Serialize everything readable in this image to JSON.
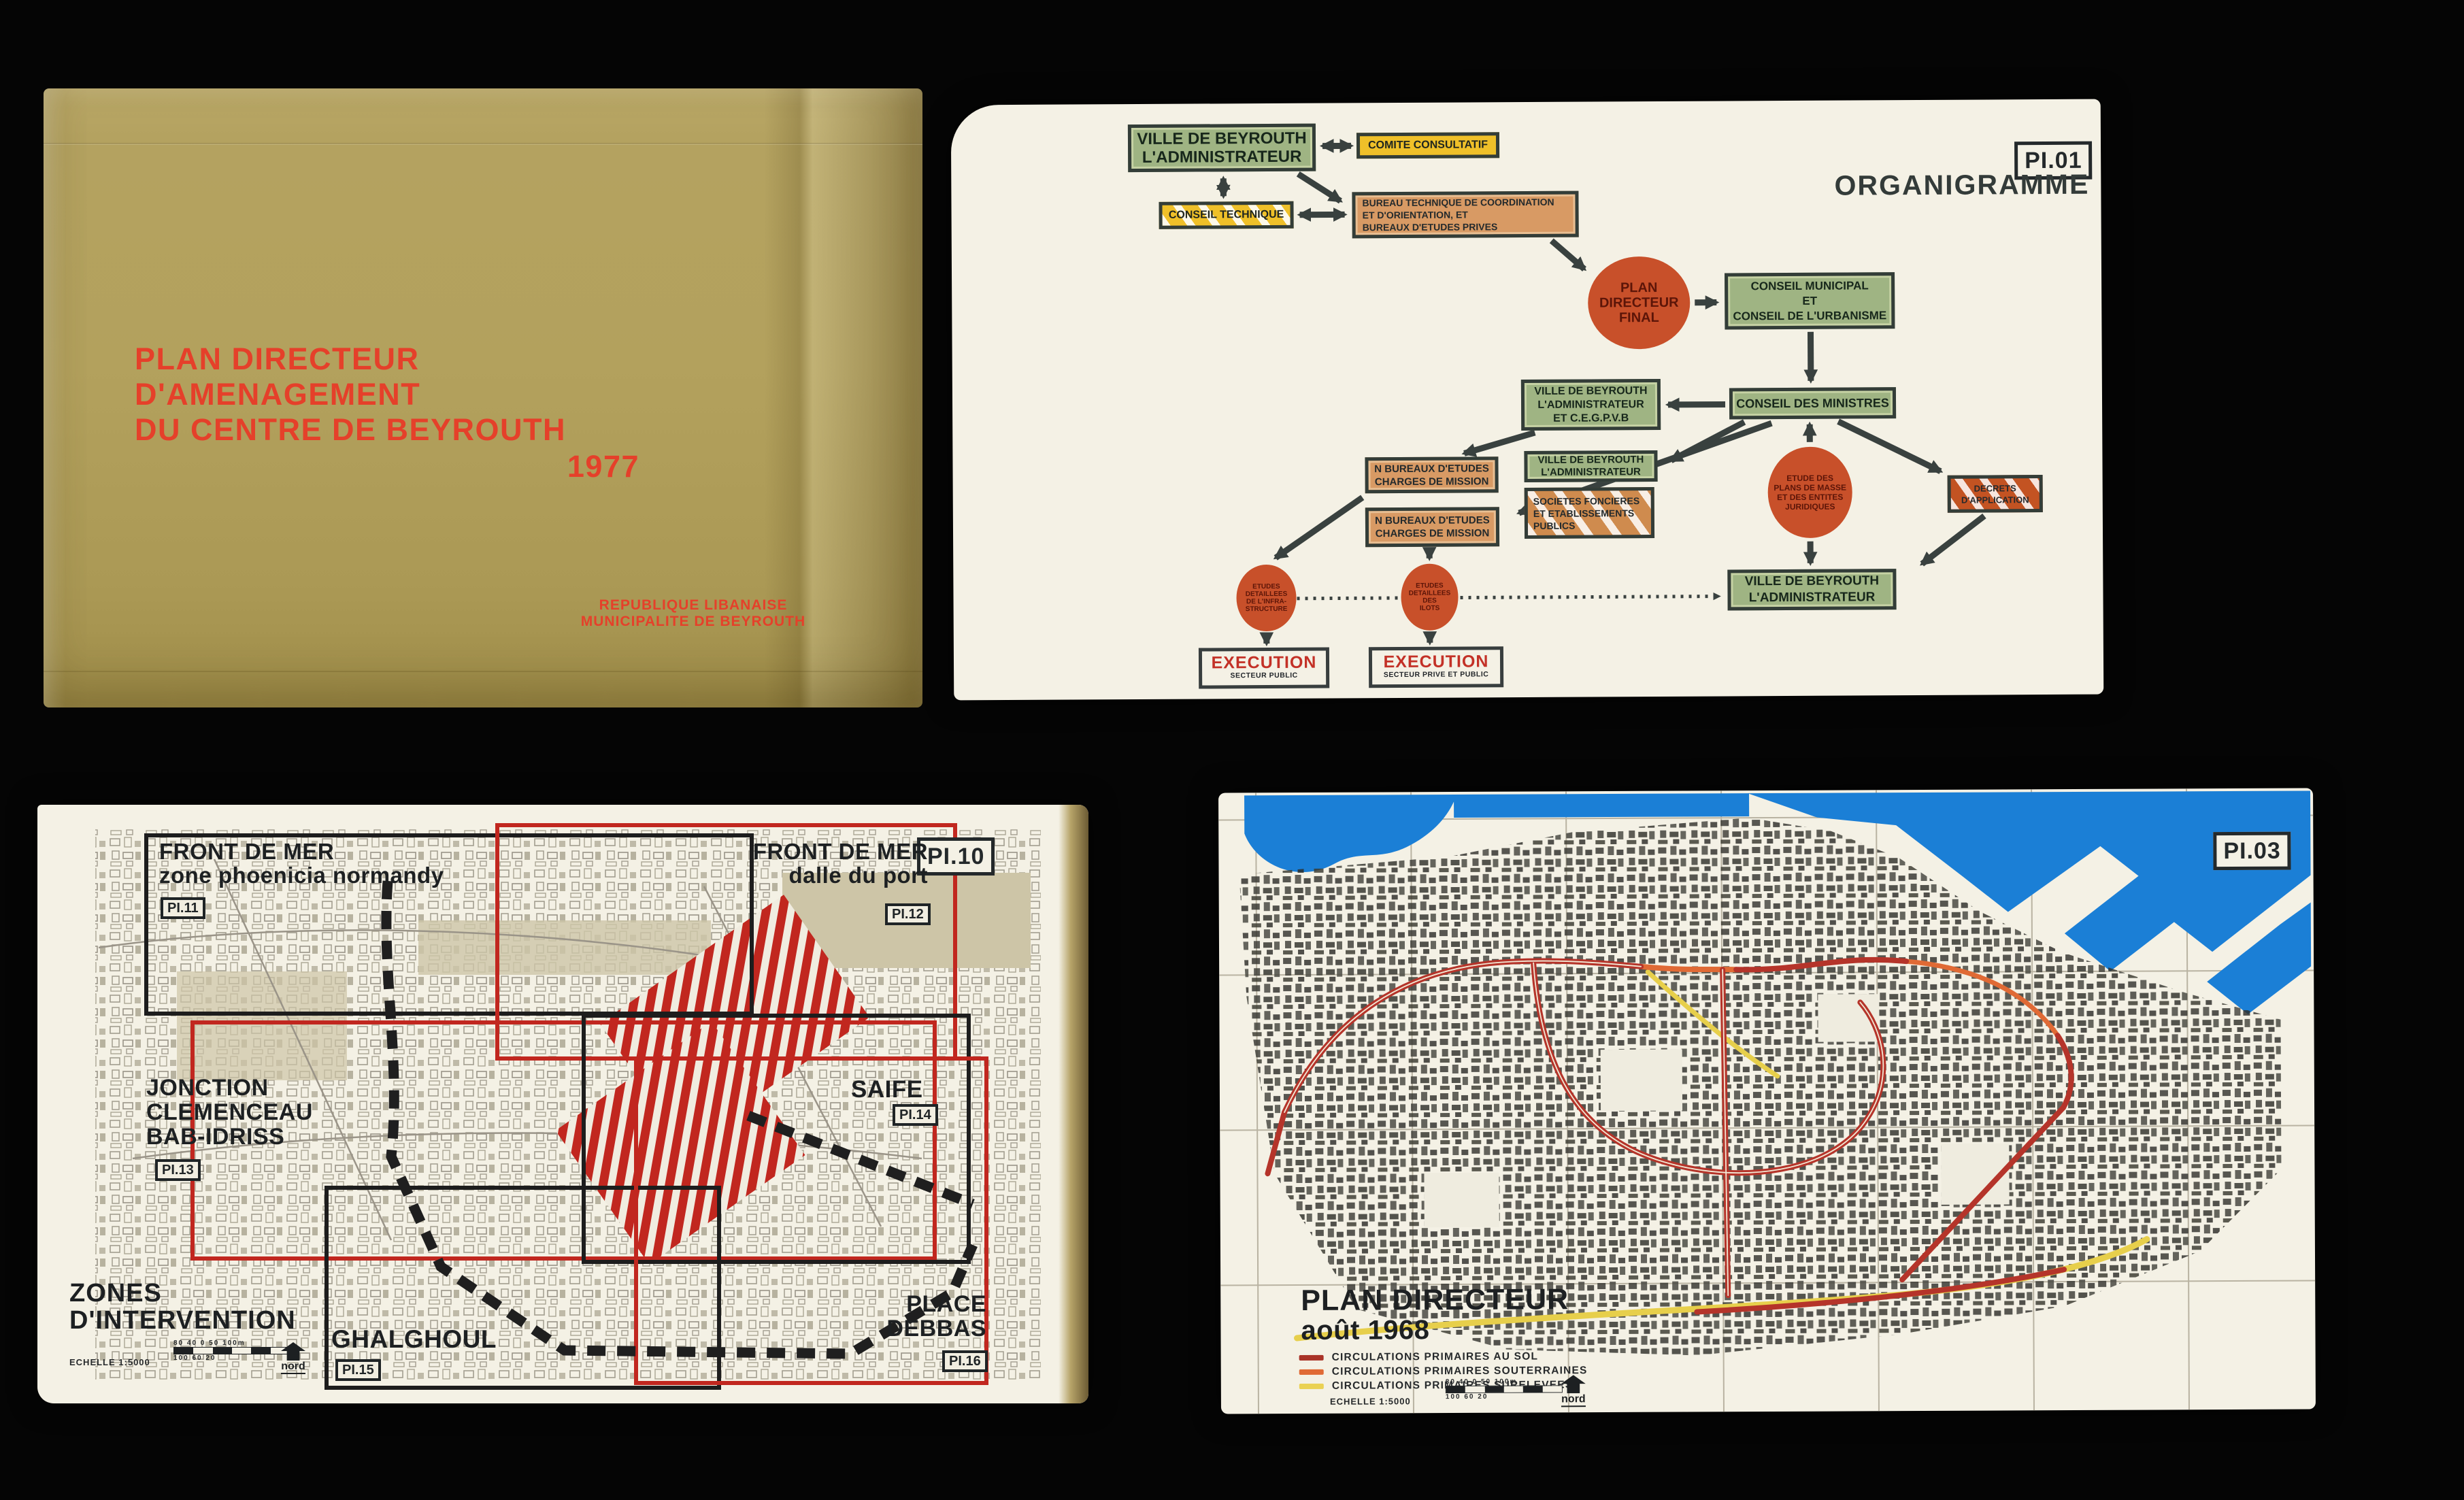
{
  "cover": {
    "title_lines": [
      "PLAN DIRECTEUR",
      "D'AMENAGEMENT",
      "DU CENTRE DE BEYROUTH"
    ],
    "title_year": "1977",
    "org_lines": [
      "REPUBLIQUE LIBANAISE",
      "MUNICIPALITE DE BEYROUTH"
    ],
    "colors": {
      "paper": "#b3a15d",
      "title_text": "#e5402a"
    }
  },
  "organigramme": {
    "plate": "PI.01",
    "title": "ORGANIGRAMME",
    "nodes": {
      "ville1": [
        "VILLE DE BEYROUTH",
        "L'ADMINISTRATEUR"
      ],
      "comite": "COMITE CONSULTATIF",
      "conseil_technique": "CONSEIL TECHNIQUE",
      "bureau_technique": [
        "BUREAU TECHNIQUE DE COORDINATION",
        "ET D'ORIENTATION,   ET",
        "BUREAUX D'ETUDES PRIVES"
      ],
      "plan_final": [
        "PLAN",
        "DIRECTEUR",
        "FINAL"
      ],
      "conseil_municipal": [
        "CONSEIL MUNICIPAL",
        "ET",
        "CONSEIL DE L'URBANISME"
      ],
      "ville_cegpvb": [
        "VILLE DE BEYROUTH",
        "L'ADMINISTRATEUR",
        "ET C.E.G.P.V.B"
      ],
      "conseil_ministres": "CONSEIL DES MINISTRES",
      "bureaux_1": [
        "N BUREAUX D'ETUDES",
        "CHARGES DE MISSION"
      ],
      "ville2": [
        "VILLE DE BEYROUTH",
        "L'ADMINISTRATEUR"
      ],
      "societes": [
        "SOCIETES FONCIERES",
        "ET ETABLISSEMENTS",
        "PUBLICS"
      ],
      "bureaux_2": [
        "N BUREAUX D'ETUDES",
        "CHARGES DE MISSION"
      ],
      "etudes_infra": [
        "ETUDES",
        "DETAILLEES",
        "DE L'INFRA-",
        "STRUCTURE"
      ],
      "etudes_ilots": [
        "ETUDES",
        "DETAILLEES",
        "DES",
        "ILOTS"
      ],
      "etude_masse": [
        "ETUDE DES",
        "PLANS DE MASSE",
        "ET DES ENTITES",
        "JURIDIQUES"
      ],
      "decrets": [
        "DECRETS",
        "D'APPLICATION"
      ],
      "ville3": [
        "VILLE DE BEYROUTH",
        "L'ADMINISTRATEUR"
      ],
      "execution_1": {
        "title": "EXECUTION",
        "subtitle": "SECTEUR PUBLIC"
      },
      "execution_2": {
        "title": "EXECUTION",
        "subtitle": "SECTEUR PRIVE ET PUBLIC"
      }
    },
    "colors": {
      "green_box": "#9fb483",
      "yellow_box": "#efc029",
      "orange_box": "#d89a64",
      "circle": "#c8502a",
      "execution_text": "#c33127"
    }
  },
  "map_zones": {
    "plate": "PI.10",
    "heading_lines": [
      "ZONES",
      "D'INTERVENTION"
    ],
    "zones": [
      {
        "lines": [
          "FRONT DE MER",
          "zone phoenicia normandy"
        ],
        "plate": "PI.11"
      },
      {
        "lines": [
          "FRONT DE MER",
          "dalle du port"
        ],
        "plate": "PI.12"
      },
      {
        "lines": [
          "JONCTION",
          "CLEMENCEAU",
          "BAB-IDRISS"
        ],
        "plate": "PI.13"
      },
      {
        "lines": [
          "SAIFE"
        ],
        "plate": "PI.14"
      },
      {
        "lines": [
          "GHALGHOUL"
        ],
        "plate": "PI.15"
      },
      {
        "lines": [
          "PLACE",
          "DEBBAS"
        ],
        "plate": "PI.16"
      }
    ],
    "scale_label": "ECHELLE 1:5000",
    "scale_numbers_top": "80 40 0 50 100m",
    "scale_numbers_bottom": "100 60 20",
    "north_label": "nord",
    "colors": {
      "zone_outline_red": "#c1271f",
      "zone_outline_black": "#1d1d1d",
      "hatch_red": "#c1271f"
    }
  },
  "map_plan": {
    "plate": "PI.03",
    "title": "PLAN DIRECTEUR",
    "subtitle": "août 1968",
    "legend": [
      {
        "swatch": "#a93327",
        "label": "CIRCULATIONS PRIMAIRES AU SOL"
      },
      {
        "swatch": "#e06a35",
        "label": "CIRCULATIONS PRIMAIRES SOUTERRAINES"
      },
      {
        "swatch": "#ead153",
        "label": "CIRCULATIONS PRIMAIRES SURELEVEES"
      }
    ],
    "scale_label": "ECHELLE 1:5000",
    "scale_numbers_top": "80 40 0 50 100m",
    "scale_numbers_bottom": "100 60 20",
    "north_label": "nord",
    "colors": {
      "water": "#1b7fd6",
      "road_red": "#b5342a",
      "road_orange": "#e06a35",
      "road_yellow": "#e7cf4b"
    }
  }
}
